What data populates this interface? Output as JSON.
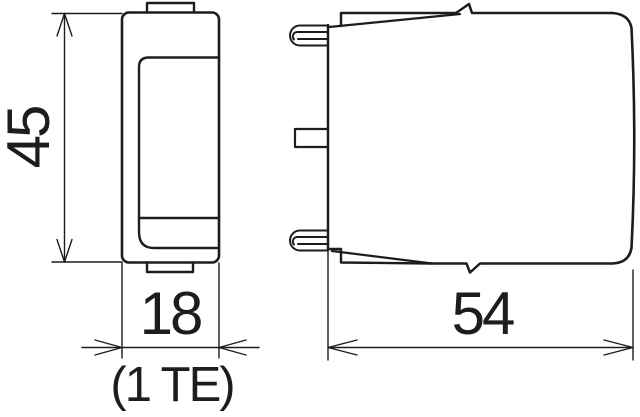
{
  "colors": {
    "line": "#1d1d1b",
    "background": "#ffffff"
  },
  "dimensions": {
    "height": {
      "label": "45"
    },
    "width": {
      "label": "18",
      "note": "(1 TE)"
    },
    "depth": {
      "label": "54"
    }
  }
}
